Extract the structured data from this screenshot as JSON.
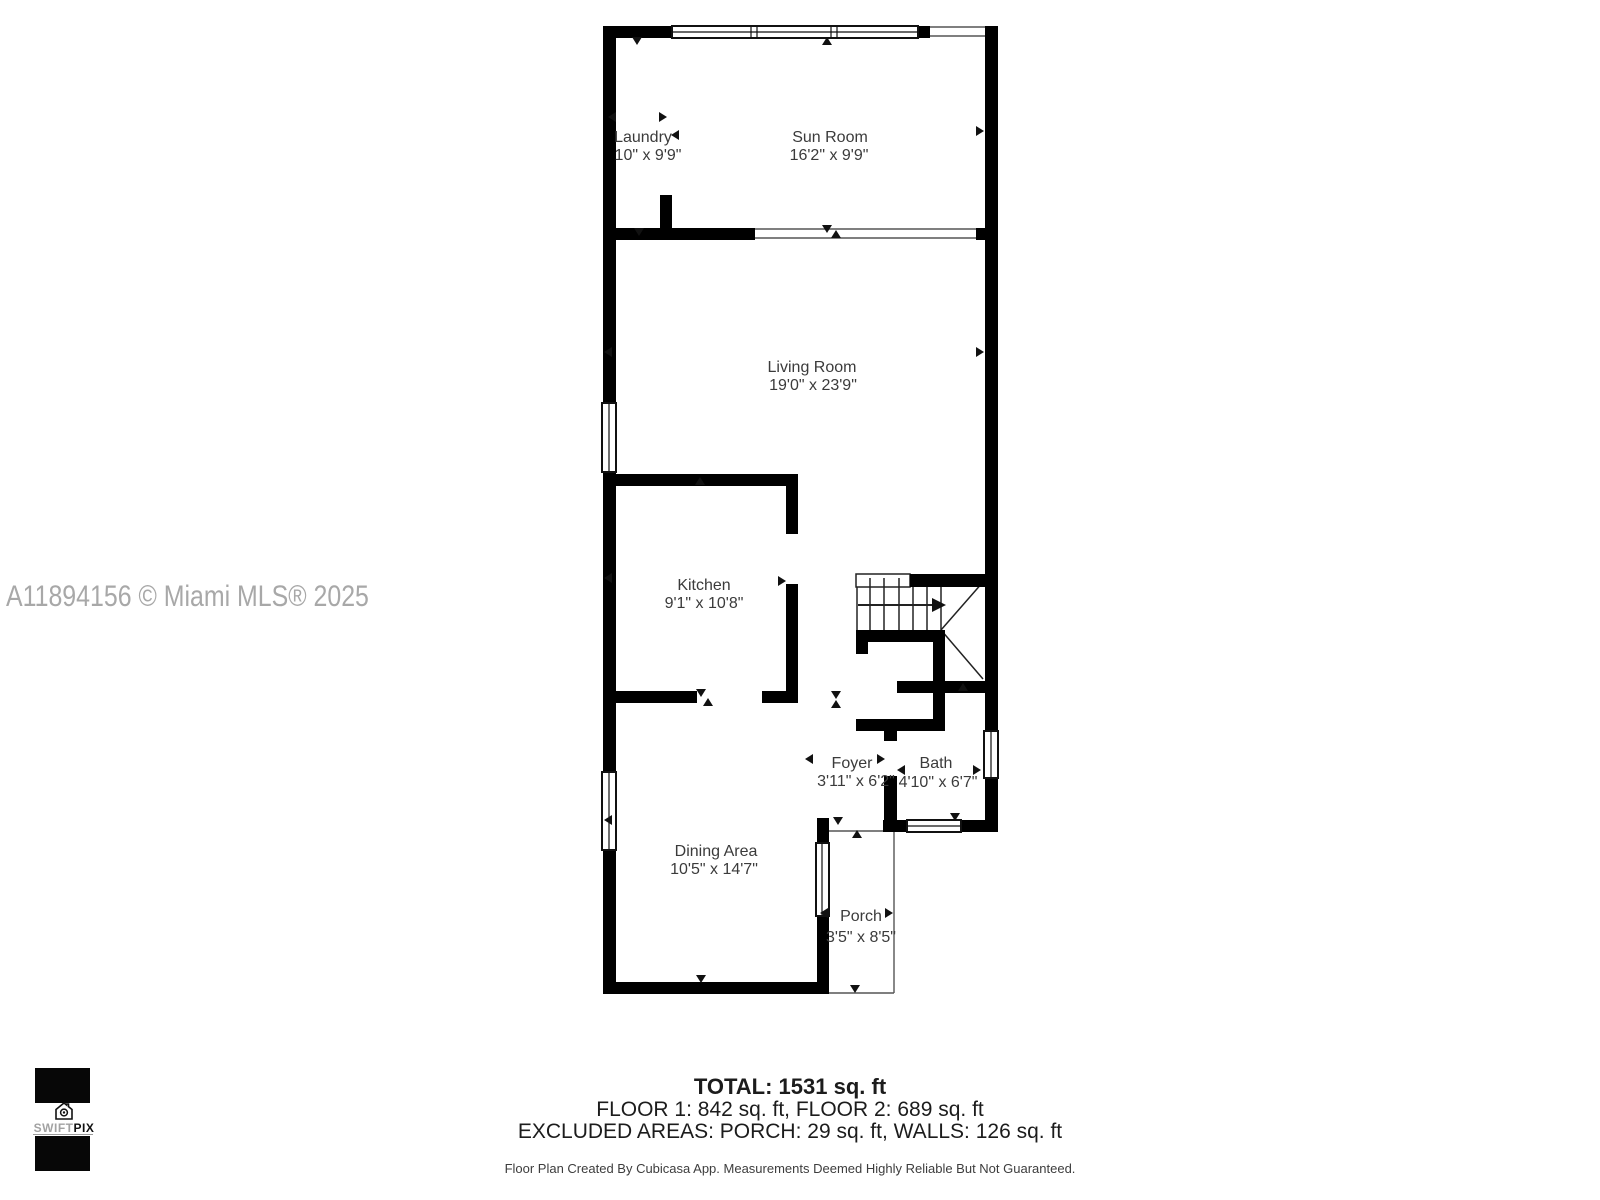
{
  "watermark": "A11894156 © Miami MLS® 2025",
  "rooms": [
    {
      "name": "Laundry",
      "dims": "10\" x 9'9\""
    },
    {
      "name": "Sun Room",
      "dims": "16'2\" x 9'9\""
    },
    {
      "name": "Living Room",
      "dims": "19'0\" x 23'9\""
    },
    {
      "name": "Kitchen",
      "dims": "9'1\" x 10'8\""
    },
    {
      "name": "Foyer",
      "dims": "3'11\" x 6'2\""
    },
    {
      "name": "Bath",
      "dims": "4'10\" x 6'7\""
    },
    {
      "name": "Dining Area",
      "dims": "10'5\" x 14'7\""
    },
    {
      "name": "Porch",
      "dims": "3'5\" x 8'5\""
    }
  ],
  "summary": {
    "total": "TOTAL: 1531 sq. ft",
    "floors": "FLOOR 1: 842 sq. ft, FLOOR 2: 689 sq. ft",
    "excluded": "EXCLUDED AREAS: PORCH: 29 sq. ft, WALLS: 126 sq. ft",
    "disclaimer": "Floor Plan Created By Cubicasa App. Measurements Deemed Highly Reliable But Not Guaranteed."
  },
  "logo": {
    "icon": "house-camera-icon",
    "brand_light": "SWIFT",
    "brand_bold": "PIX"
  },
  "colors": {
    "wall": "#000000",
    "room_text": "#3b3b3b",
    "watermark": "#a8a8a8"
  }
}
